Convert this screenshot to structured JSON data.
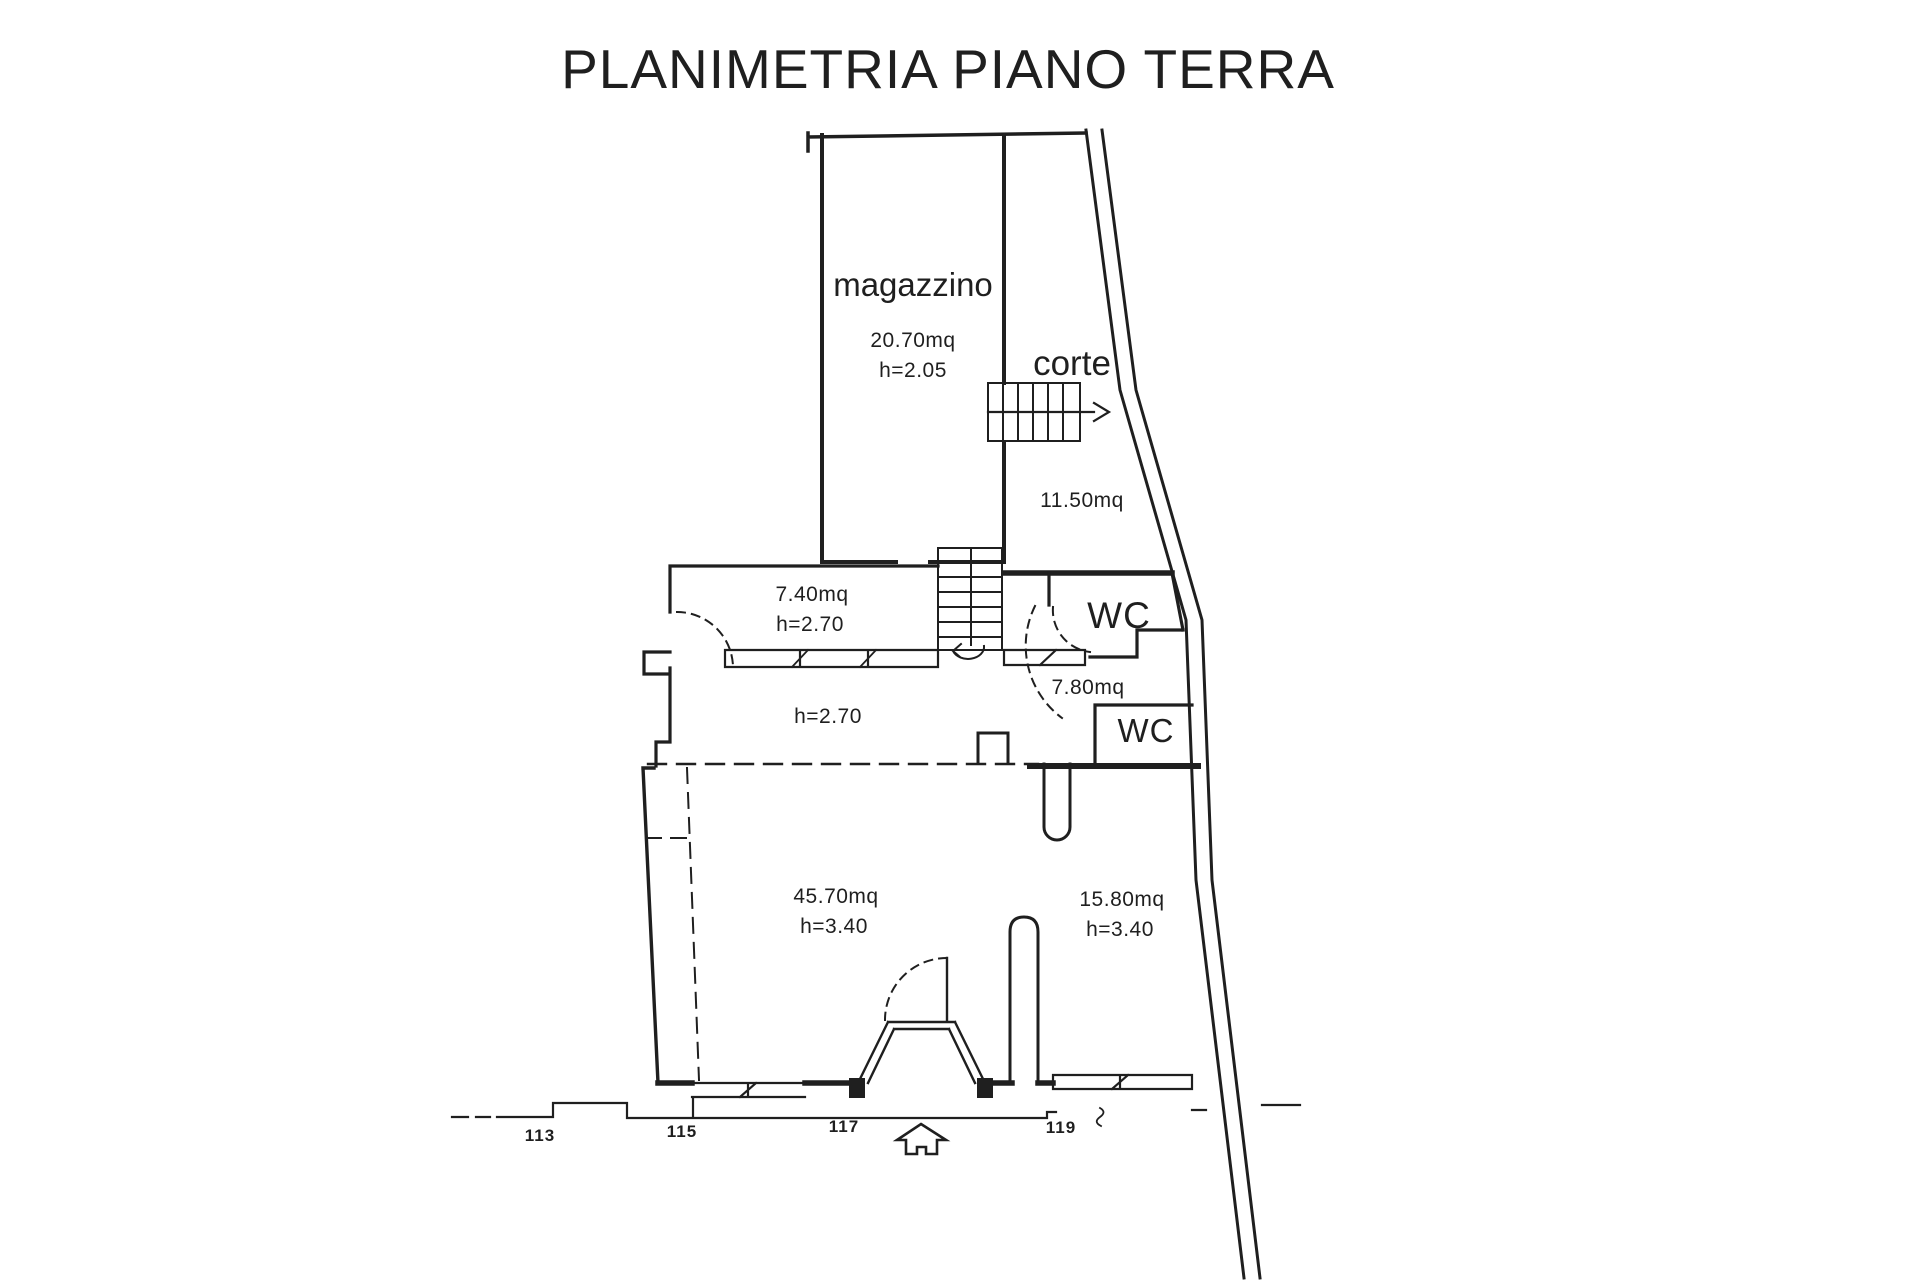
{
  "title": "PLANIMETRIA PIANO TERRA",
  "labels": {
    "magazzino": {
      "name": "magazzino",
      "area": "20.70mq",
      "height": "h=2.05"
    },
    "corte": {
      "name": "corte",
      "area": "11.50mq"
    },
    "storage": {
      "area": "7.40mq",
      "height": "h=2.70"
    },
    "hallway": {
      "height": "h=2.70"
    },
    "wc_upper": {
      "name": "WC"
    },
    "antibagno": {
      "area": "7.80mq"
    },
    "wc_lower": {
      "name": "WC"
    },
    "main_room": {
      "area": "45.70mq",
      "height": "h=3.40"
    },
    "side_room": {
      "area": "15.80mq",
      "height": "h=3.40"
    }
  },
  "street_numbers": [
    "113",
    "115",
    "117",
    "119"
  ],
  "colors": {
    "ink": "#1f1f1f",
    "paper": "#ffffff"
  }
}
